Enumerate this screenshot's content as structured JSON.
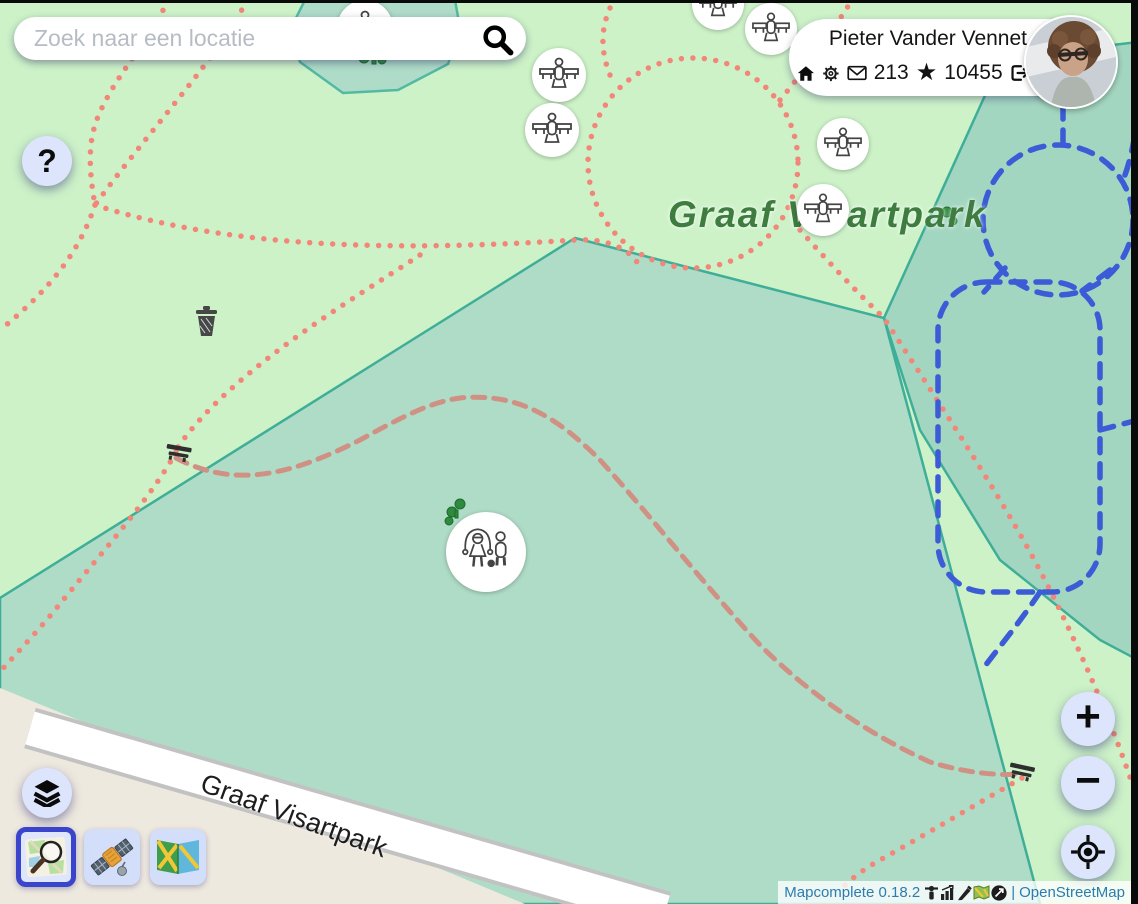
{
  "search": {
    "placeholder": "Zoek naar een locatie"
  },
  "help_button": {
    "label": "?"
  },
  "user_panel": {
    "name": "Pieter Vander Vennet",
    "messages_count": "213",
    "changesets_count": "10455",
    "star_glyph": "★"
  },
  "map": {
    "park_label": "Graaf Visartpark",
    "road_label": "Graaf Visartpark",
    "marker_types": [
      "picnic-table",
      "playground"
    ],
    "poi_icons": [
      "trash-can",
      "bench",
      "trees"
    ]
  },
  "controls": {
    "zoom_in": "+",
    "zoom_out": "−"
  },
  "attribution": {
    "app_version": "Mapcomplete 0.18.2",
    "icon_names": [
      "stats-icon",
      "chart-icon",
      "pencil-icon",
      "map-icon",
      "copyright-icon"
    ],
    "separator": "|",
    "osm_link": "OpenStreetMap"
  },
  "colors": {
    "park_green": "#cdf2c8",
    "wood_teal": "#afdcc7",
    "wood_teal_dark": "#a3d6c1",
    "area_stroke": "#3fae98",
    "residential_beige": "#eee9df",
    "path_red": "#f28678",
    "path_red_muted": "#cf9183",
    "path_blue": "#3b5cd6",
    "button_bg": "#dce5fc",
    "selected_border": "#3b45cc",
    "label_green": "#3e7c40",
    "attribution_blue": "#2c7cb0"
  }
}
